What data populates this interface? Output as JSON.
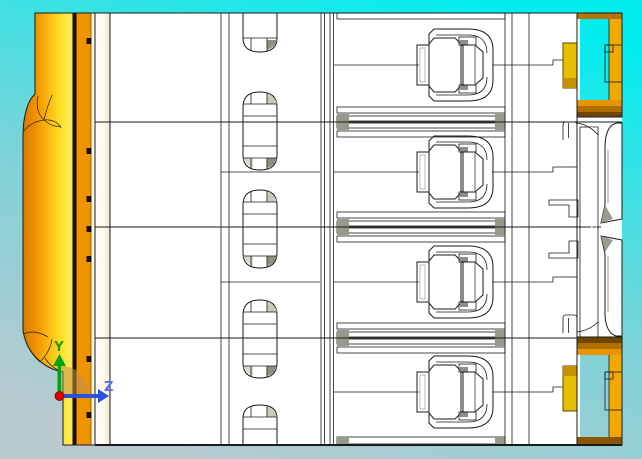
{
  "viewport": {
    "description": "cad-orthographic-view",
    "poles": 4,
    "mounting_slots": 5
  },
  "triad": {
    "y_label": "Y",
    "z_label": "Z"
  },
  "colors": {
    "bg_top": "#04edee",
    "bg_mid": "#7fd2d8",
    "bg_bottom": "#b8cacf",
    "busbar_deep": "#c87000",
    "busbar_orange": "#f29600",
    "busbar_bright": "#ffee58",
    "busbar_side": "#ef9400",
    "lug_yellow": "#ffd816",
    "lug_orange": "#f2a800",
    "lug_shadow": "#8a5600",
    "housing_white": "#ffffff",
    "wall_beige": "#e6e3cb",
    "band_gray": "#d6d5c6",
    "band_gray_dark": "#c9c8b9",
    "edge_gray": "#d8d8cc",
    "mech_gray": "#c2c1b2",
    "axis_y": "#00a510",
    "axis_z": "#2b50e0",
    "origin_red": "#e00000",
    "label_y": "#1fa000",
    "label_z": "#4f6fe8"
  }
}
